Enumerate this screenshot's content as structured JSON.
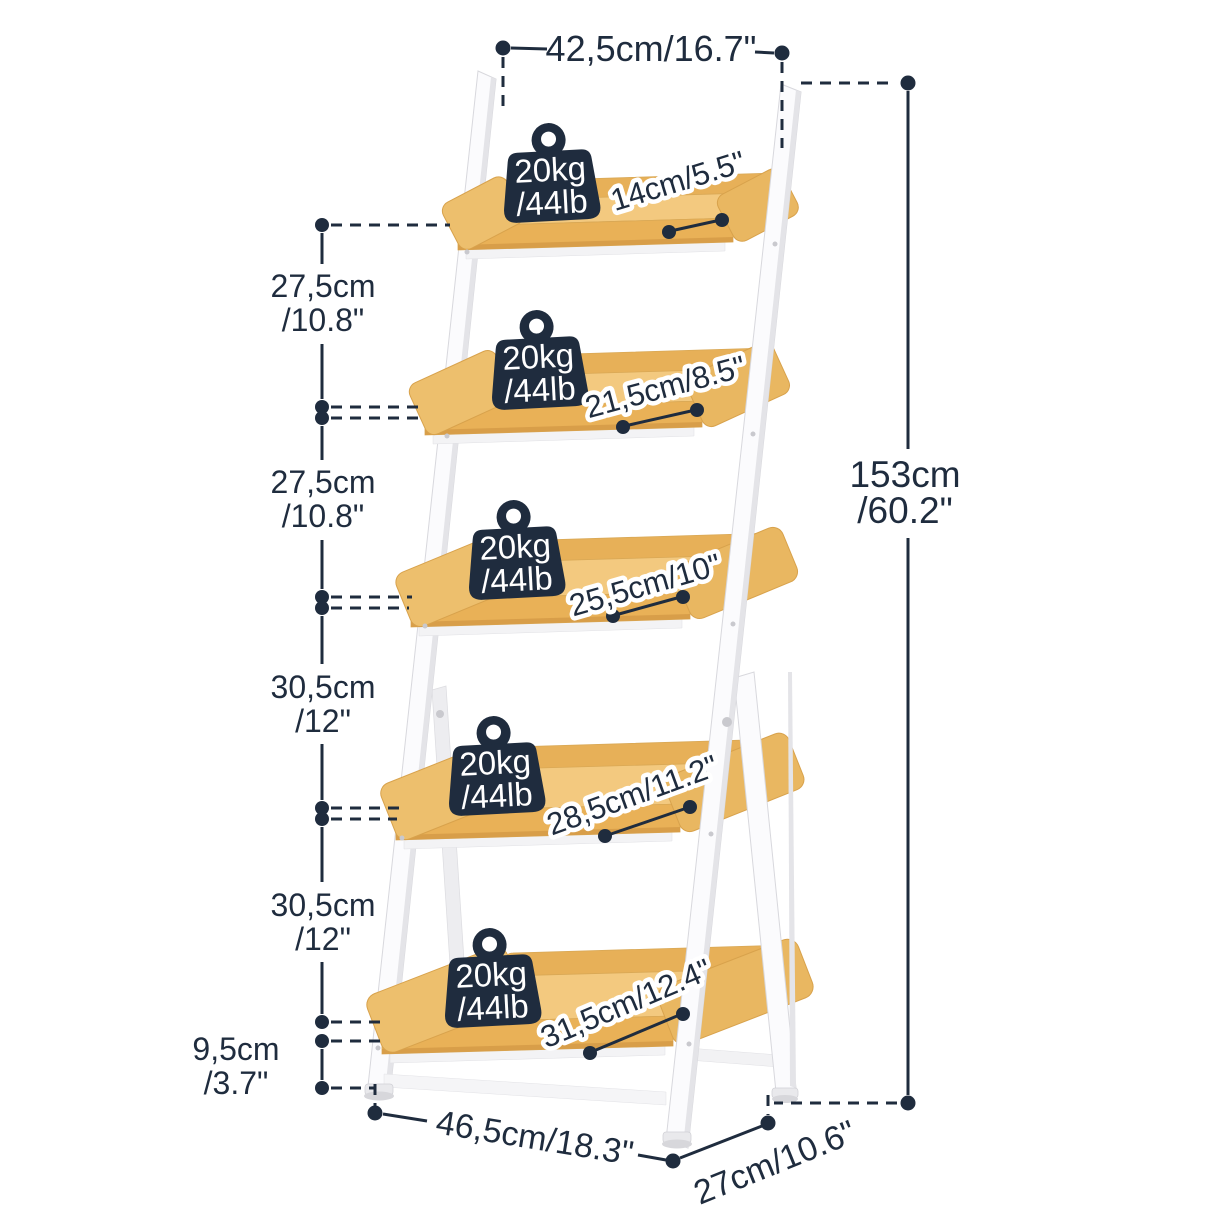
{
  "colors": {
    "annotation": "#1f2c3e",
    "badge": "#1f2c3e",
    "wood_top": "#f3c97f",
    "wood_front": "#e9b157",
    "wood_lip": "#e7b058",
    "wood_cap": "#edbf6d",
    "frame_white": "#fbfbfd",
    "frame_shadow": "#e4e4e8"
  },
  "dimensions": {
    "top_width": "42,5cm/16.7\"",
    "total_height": {
      "cm": "153cm",
      "in": "/60.2\""
    },
    "left_gaps": [
      {
        "cm": "27,5cm",
        "in": "/10.8\""
      },
      {
        "cm": "27,5cm",
        "in": "/10.8\""
      },
      {
        "cm": "30,5cm",
        "in": "/12\""
      },
      {
        "cm": "30,5cm",
        "in": "/12\""
      },
      {
        "cm": "9,5cm",
        "in": "/3.7\""
      }
    ],
    "shelf_depths": [
      "14cm/5.5\"",
      "21,5cm/8.5\"",
      "25,5cm/10\"",
      "28,5cm/11.2\"",
      "31,5cm/12.4\""
    ],
    "bottom_width": "46,5cm/18.3\"",
    "base_depth": "27cm/10.6\""
  },
  "weight_badges": [
    {
      "kg": "20kg",
      "lb": "/44lb"
    },
    {
      "kg": "20kg",
      "lb": "/44lb"
    },
    {
      "kg": "20kg",
      "lb": "/44lb"
    },
    {
      "kg": "20kg",
      "lb": "/44lb"
    },
    {
      "kg": "20kg",
      "lb": "/44lb"
    }
  ]
}
